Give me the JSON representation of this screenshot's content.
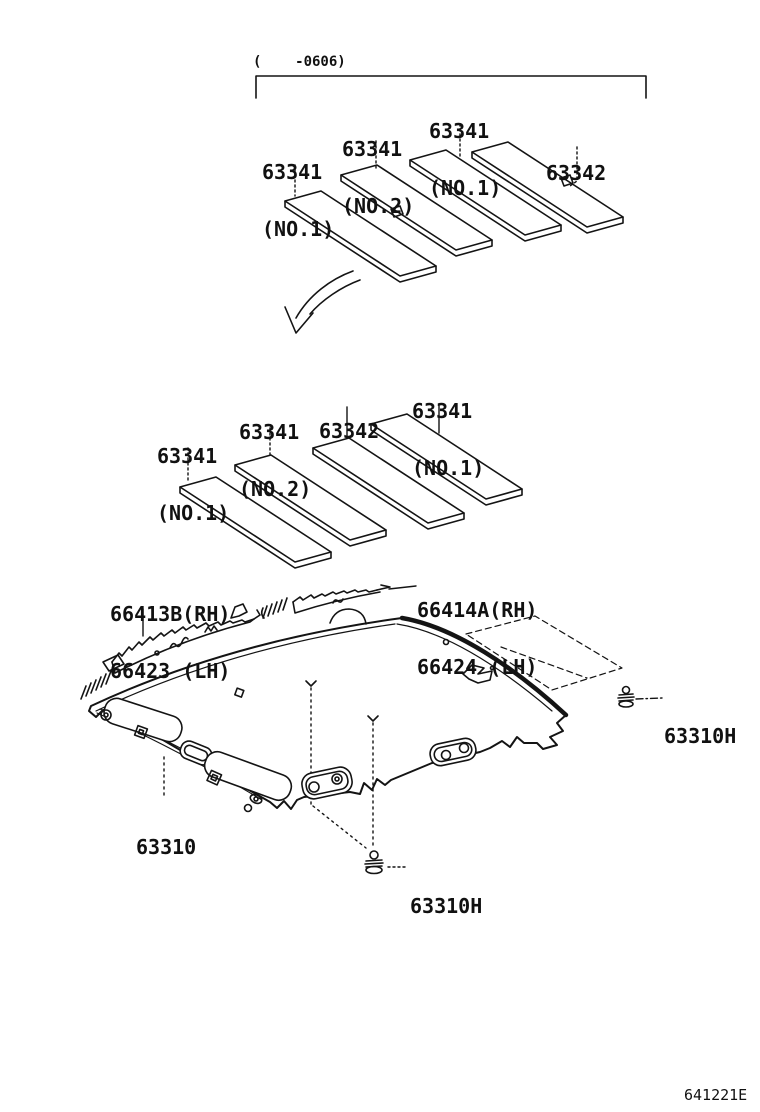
{
  "diagram": {
    "type": "parts-diagram",
    "subject": "roof headlining and silencer pads",
    "applicability_note": "(    -0606)",
    "doc_code": "641221E"
  },
  "labels": {
    "g1_top": {
      "l1": "63341",
      "l2": "(NO.1)"
    },
    "g1_no2": {
      "l1": "63341",
      "l2": "(NO.2)"
    },
    "g1_left": {
      "l1": "63341",
      "l2": "(NO.1)"
    },
    "g1_63342": {
      "l1": "63342"
    },
    "g2_right": {
      "l1": "63341",
      "l2": "(NO.1)"
    },
    "g2_63342": {
      "l1": "63342"
    },
    "g2_no2": {
      "l1": "63341",
      "l2": "(NO.2)"
    },
    "g2_left": {
      "l1": "63341",
      "l2": "(NO.1)"
    },
    "moulding_left": {
      "l1": "66413B(RH)",
      "l2": "66423 (LH)"
    },
    "moulding_right": {
      "l1": "66414A(RH)",
      "l2": "66424 (LH)"
    },
    "clip_right": {
      "l1": "63310H"
    },
    "clip_bottom": {
      "l1": "63310H"
    },
    "headlining": {
      "l1": "63310"
    }
  },
  "colors": {
    "line": "#141414",
    "background": "#ffffff"
  }
}
